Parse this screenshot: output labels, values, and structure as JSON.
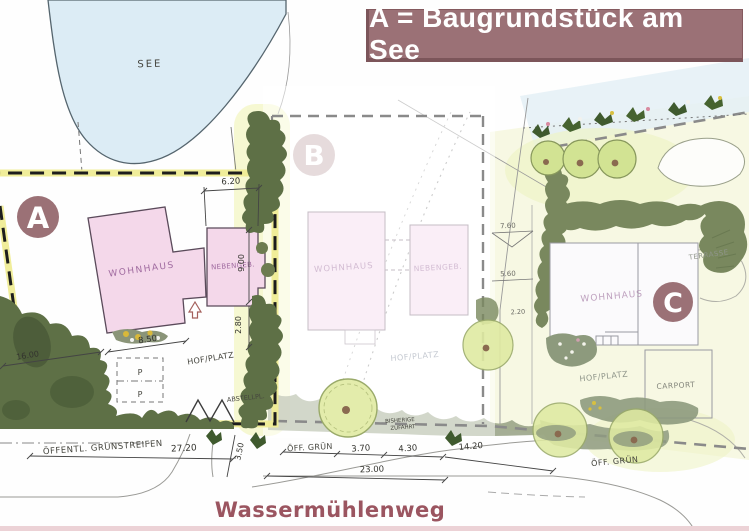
{
  "banner": {
    "text": "A = Baugrundstück am See",
    "bg_color": "#9b7176",
    "text_color": "#ffffff"
  },
  "street": {
    "name": "Wassermühlenweg",
    "name_color": "#9b5560"
  },
  "lake": {
    "label": "SEE",
    "fill_color": "#dcecf5"
  },
  "plots": {
    "a": {
      "badge": "A",
      "labels": {
        "wohnhaus": "WOHNHAUS",
        "nebengeb": "NEBENGEB.",
        "hof_platz": "HOF/PLATZ",
        "abstellplatz": "ABSTELLPL.",
        "parking": "P",
        "gruenstreifen": "ÖFFENTL. GRÜNSTREIFEN"
      },
      "dims": {
        "top": "6.20",
        "side": "9.00",
        "lower": "2.80",
        "front": "8.50",
        "left": "16.00",
        "gruen_width": "27.20",
        "flare": "3.50"
      }
    },
    "b": {
      "badge": "B",
      "labels": {
        "wohnhaus": "WOHNHAUS",
        "nebengeb": "NEBENGEB.",
        "hof_platz": "HOF/PLATZ",
        "zufahrt_line1": "BISHERIGE",
        "zufahrt_line2": "ZUFAHRT",
        "gruen": "ÖFF. GRÜN"
      },
      "dims": {
        "d1": "3.70",
        "d2": "4.30",
        "total": "23.00",
        "right": "14.20"
      }
    },
    "c": {
      "badge": "C",
      "labels": {
        "wohnhaus": "WOHNHAUS",
        "hof_platz": "HOF/PLATZ",
        "carport": "CARPORT",
        "terrasse": "TERRASSE",
        "gruen": "ÖFF. GRÜN"
      },
      "dims": {
        "d1": "7.60",
        "d2": "5.60",
        "d3": "2.20"
      }
    }
  },
  "colors": {
    "badge_bg": "#9b7176",
    "plot_a_boundary_highlight": "#efec95",
    "vegetation_dark": "#5e7046",
    "tree_light": "#e3ecab",
    "building_pink": "#f4d8ea"
  }
}
